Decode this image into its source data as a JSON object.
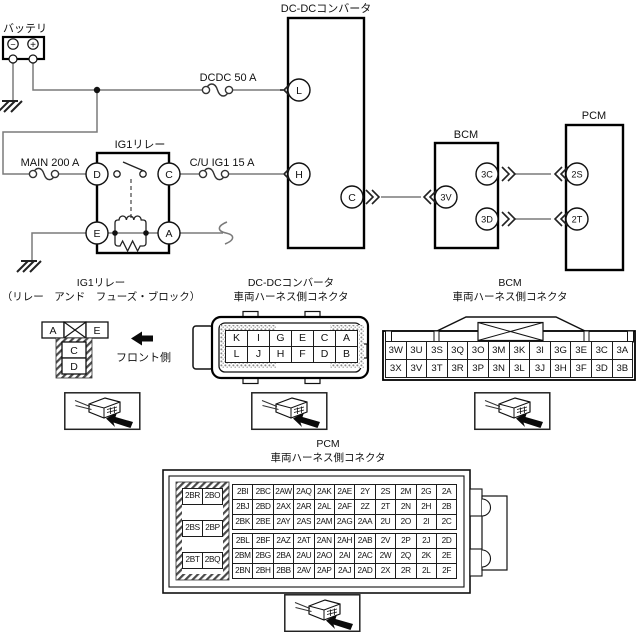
{
  "colors": {
    "background": "#ffffff",
    "wire": "#7a7a7a",
    "line": "#111111"
  },
  "schematic": {
    "battery": {
      "label": "バッテリ",
      "minus": "−",
      "plus": "+"
    },
    "fuse_dcdc": "DCDC 50 A",
    "fuse_main": "MAIN 200 A",
    "fuse_cu_ig1": "C/U IG1 15 A",
    "relay": {
      "label": "IG1リレー",
      "pin_d": "D",
      "pin_c": "C",
      "pin_e": "E",
      "pin_a": "A"
    },
    "dcdc": {
      "label": "DC-DCコンバータ",
      "pin_l": "L",
      "pin_h": "H",
      "pin_c": "C"
    },
    "bcm": {
      "label": "BCM",
      "pin_3v": "3V",
      "pin_3c": "3C",
      "pin_3d": "3D"
    },
    "pcm": {
      "label": "PCM",
      "pin_2s": "2S",
      "pin_2t": "2T"
    }
  },
  "connector_sections": {
    "relay": {
      "title1": "IG1リレー",
      "title2": "（リレー　アンド　フューズ・ブロック）",
      "front_label": "フロント側",
      "top_row": [
        "A",
        "E"
      ],
      "stack": [
        "C",
        "D"
      ]
    },
    "dcdc": {
      "title1": "DC-DCコンバータ",
      "title2": "車両ハーネス側コネクタ",
      "rows": [
        [
          "K",
          "I",
          "G",
          "E",
          "C",
          "A"
        ],
        [
          "L",
          "J",
          "H",
          "F",
          "D",
          "B"
        ]
      ]
    },
    "bcm": {
      "title1": "BCM",
      "title2": "車両ハーネス側コネクタ",
      "rows": [
        [
          "3W",
          "3U",
          "3S",
          "3Q",
          "3O",
          "3M",
          "3K",
          "3I",
          "3G",
          "3E",
          "3C",
          "3A"
        ],
        [
          "3X",
          "3V",
          "3T",
          "3R",
          "3P",
          "3N",
          "3L",
          "3J",
          "3H",
          "3F",
          "3D",
          "3B"
        ]
      ]
    },
    "pcm": {
      "title1": "PCM",
      "title2": "車両ハーネス側コネクタ",
      "side_rows": [
        [
          "2BR",
          "2BO"
        ],
        [
          "2BS",
          "2BP"
        ],
        [
          "2BT",
          "2BQ"
        ]
      ],
      "upper_rows": [
        [
          "2BI",
          "2BC",
          "2AW",
          "2AQ",
          "2AK",
          "2AE",
          "2Y",
          "2S",
          "2M",
          "2G",
          "2A"
        ],
        [
          "2BJ",
          "2BD",
          "2AX",
          "2AR",
          "2AL",
          "2AF",
          "2Z",
          "2T",
          "2N",
          "2H",
          "2B"
        ],
        [
          "2BK",
          "2BE",
          "2AY",
          "2AS",
          "2AM",
          "2AG",
          "2AA",
          "2U",
          "2O",
          "2I",
          "2C"
        ]
      ],
      "lower_rows": [
        [
          "2BL",
          "2BF",
          "2AZ",
          "2AT",
          "2AN",
          "2AH",
          "2AB",
          "2V",
          "2P",
          "2J",
          "2D"
        ],
        [
          "2BM",
          "2BG",
          "2BA",
          "2AU",
          "2AO",
          "2AI",
          "2AC",
          "2W",
          "2Q",
          "2K",
          "2E"
        ],
        [
          "2BN",
          "2BH",
          "2BB",
          "2AV",
          "2AP",
          "2AJ",
          "2AD",
          "2X",
          "2R",
          "2L",
          "2F"
        ]
      ]
    }
  }
}
